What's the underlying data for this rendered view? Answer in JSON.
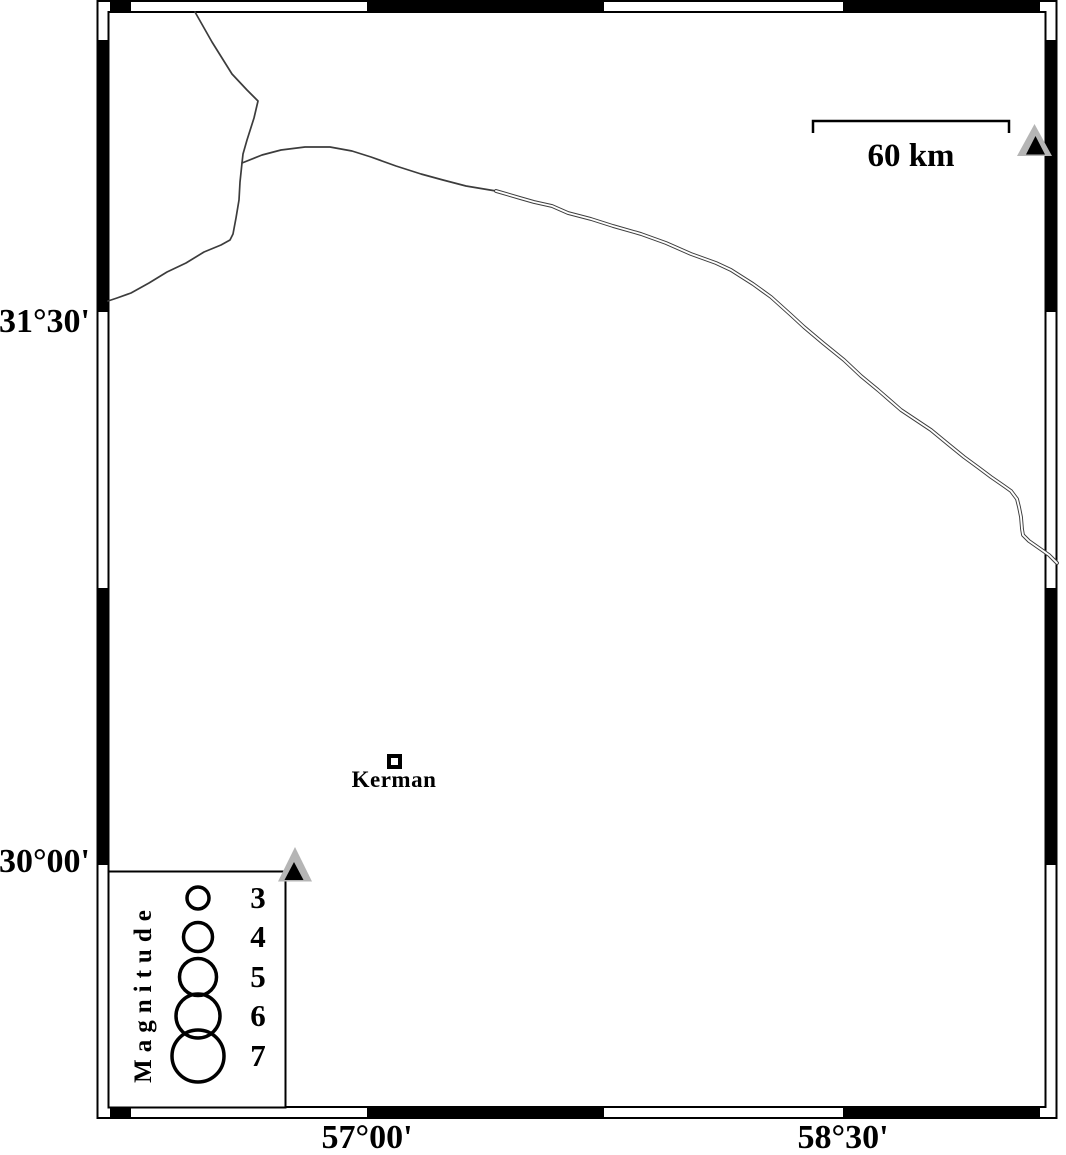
{
  "frame": {
    "lat_labels": [
      "31°30'",
      "30°00'"
    ],
    "lon_labels": [
      "57°00'",
      "58°30'"
    ]
  },
  "scale_bar": {
    "label": "60 km"
  },
  "city": {
    "name": "Kerman"
  },
  "legend": {
    "title": "Magnitude",
    "items": [
      {
        "magnitude": "3",
        "radius": 11
      },
      {
        "magnitude": "4",
        "radius": 14.5
      },
      {
        "magnitude": "5",
        "radius": 18.5
      },
      {
        "magnitude": "6",
        "radius": 22
      },
      {
        "magnitude": "7",
        "radius": 26
      }
    ]
  },
  "colors": {
    "frame_fill": "#000000",
    "line": "#3c3c3c",
    "station_fill": "#b5b5b5",
    "station_inner": "#000000",
    "background": "#ffffff"
  }
}
